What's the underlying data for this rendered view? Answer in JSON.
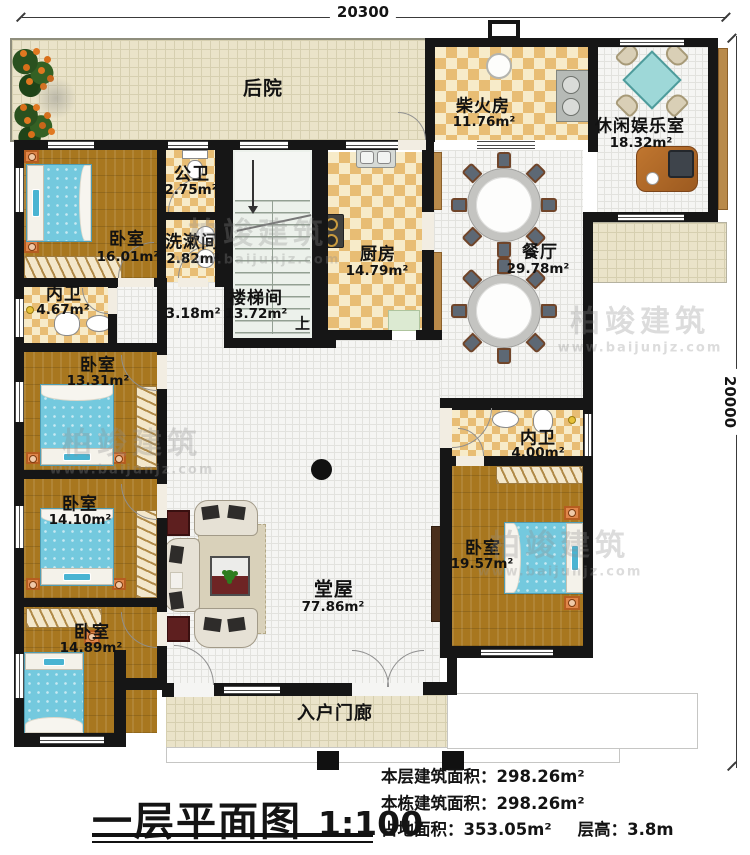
{
  "plan": {
    "title": "一层平面图",
    "scale": "1:100",
    "dim_top": "20300",
    "dim_right": "20000",
    "up": "上",
    "watermark": {
      "brand": "柏竣建筑",
      "site": "www.baijunjz.com"
    },
    "stats": {
      "l1": "本层建筑面积：",
      "v1": "298.26m²",
      "l2": "本栋建筑面积：",
      "v2": "298.26m²",
      "l3": "占地面积：",
      "v3": "353.05m²",
      "l4": "层高：",
      "v4": "3.8m"
    },
    "rooms": {
      "backyard": {
        "name": "后院"
      },
      "firewood": {
        "name": "柴火房",
        "area": "11.76m²"
      },
      "leisure": {
        "name": "休闲娱乐室",
        "area": "18.32m²"
      },
      "pubbath": {
        "name": "公卫",
        "area": "2.75m²"
      },
      "bedroom1": {
        "name": "卧室",
        "area": "16.01m²"
      },
      "washroom": {
        "name": "洗漱间",
        "area": "2.82m²"
      },
      "kitchen": {
        "name": "厨房",
        "area": "14.79m²"
      },
      "dining": {
        "name": "餐厅",
        "area": "29.78m²"
      },
      "ensuite1": {
        "name": "内卫",
        "area": "4.67m²"
      },
      "stairwell": {
        "name": "楼梯间",
        "area": "13.72m²"
      },
      "corridor": {
        "area": "3.18m²"
      },
      "bedroom2": {
        "name": "卧室",
        "area": "13.31m²"
      },
      "bedroom3": {
        "name": "卧室",
        "area": "14.10m²"
      },
      "bedroom4": {
        "name": "卧室",
        "area": "14.89m²"
      },
      "hall": {
        "name": "堂屋",
        "area": "77.86m²"
      },
      "ensuite2": {
        "name": "内卫",
        "area": "4.00m²"
      },
      "bedroom5": {
        "name": "卧室",
        "area": "19.57m²"
      },
      "porch": {
        "name": "入户门廊"
      }
    },
    "colors": {
      "wall": "#161616",
      "wood": "#a8771f",
      "checker": "#e8bd74",
      "bed": "#74c9de",
      "maroon": "#6e2424",
      "tan": "#b98a4a"
    }
  }
}
